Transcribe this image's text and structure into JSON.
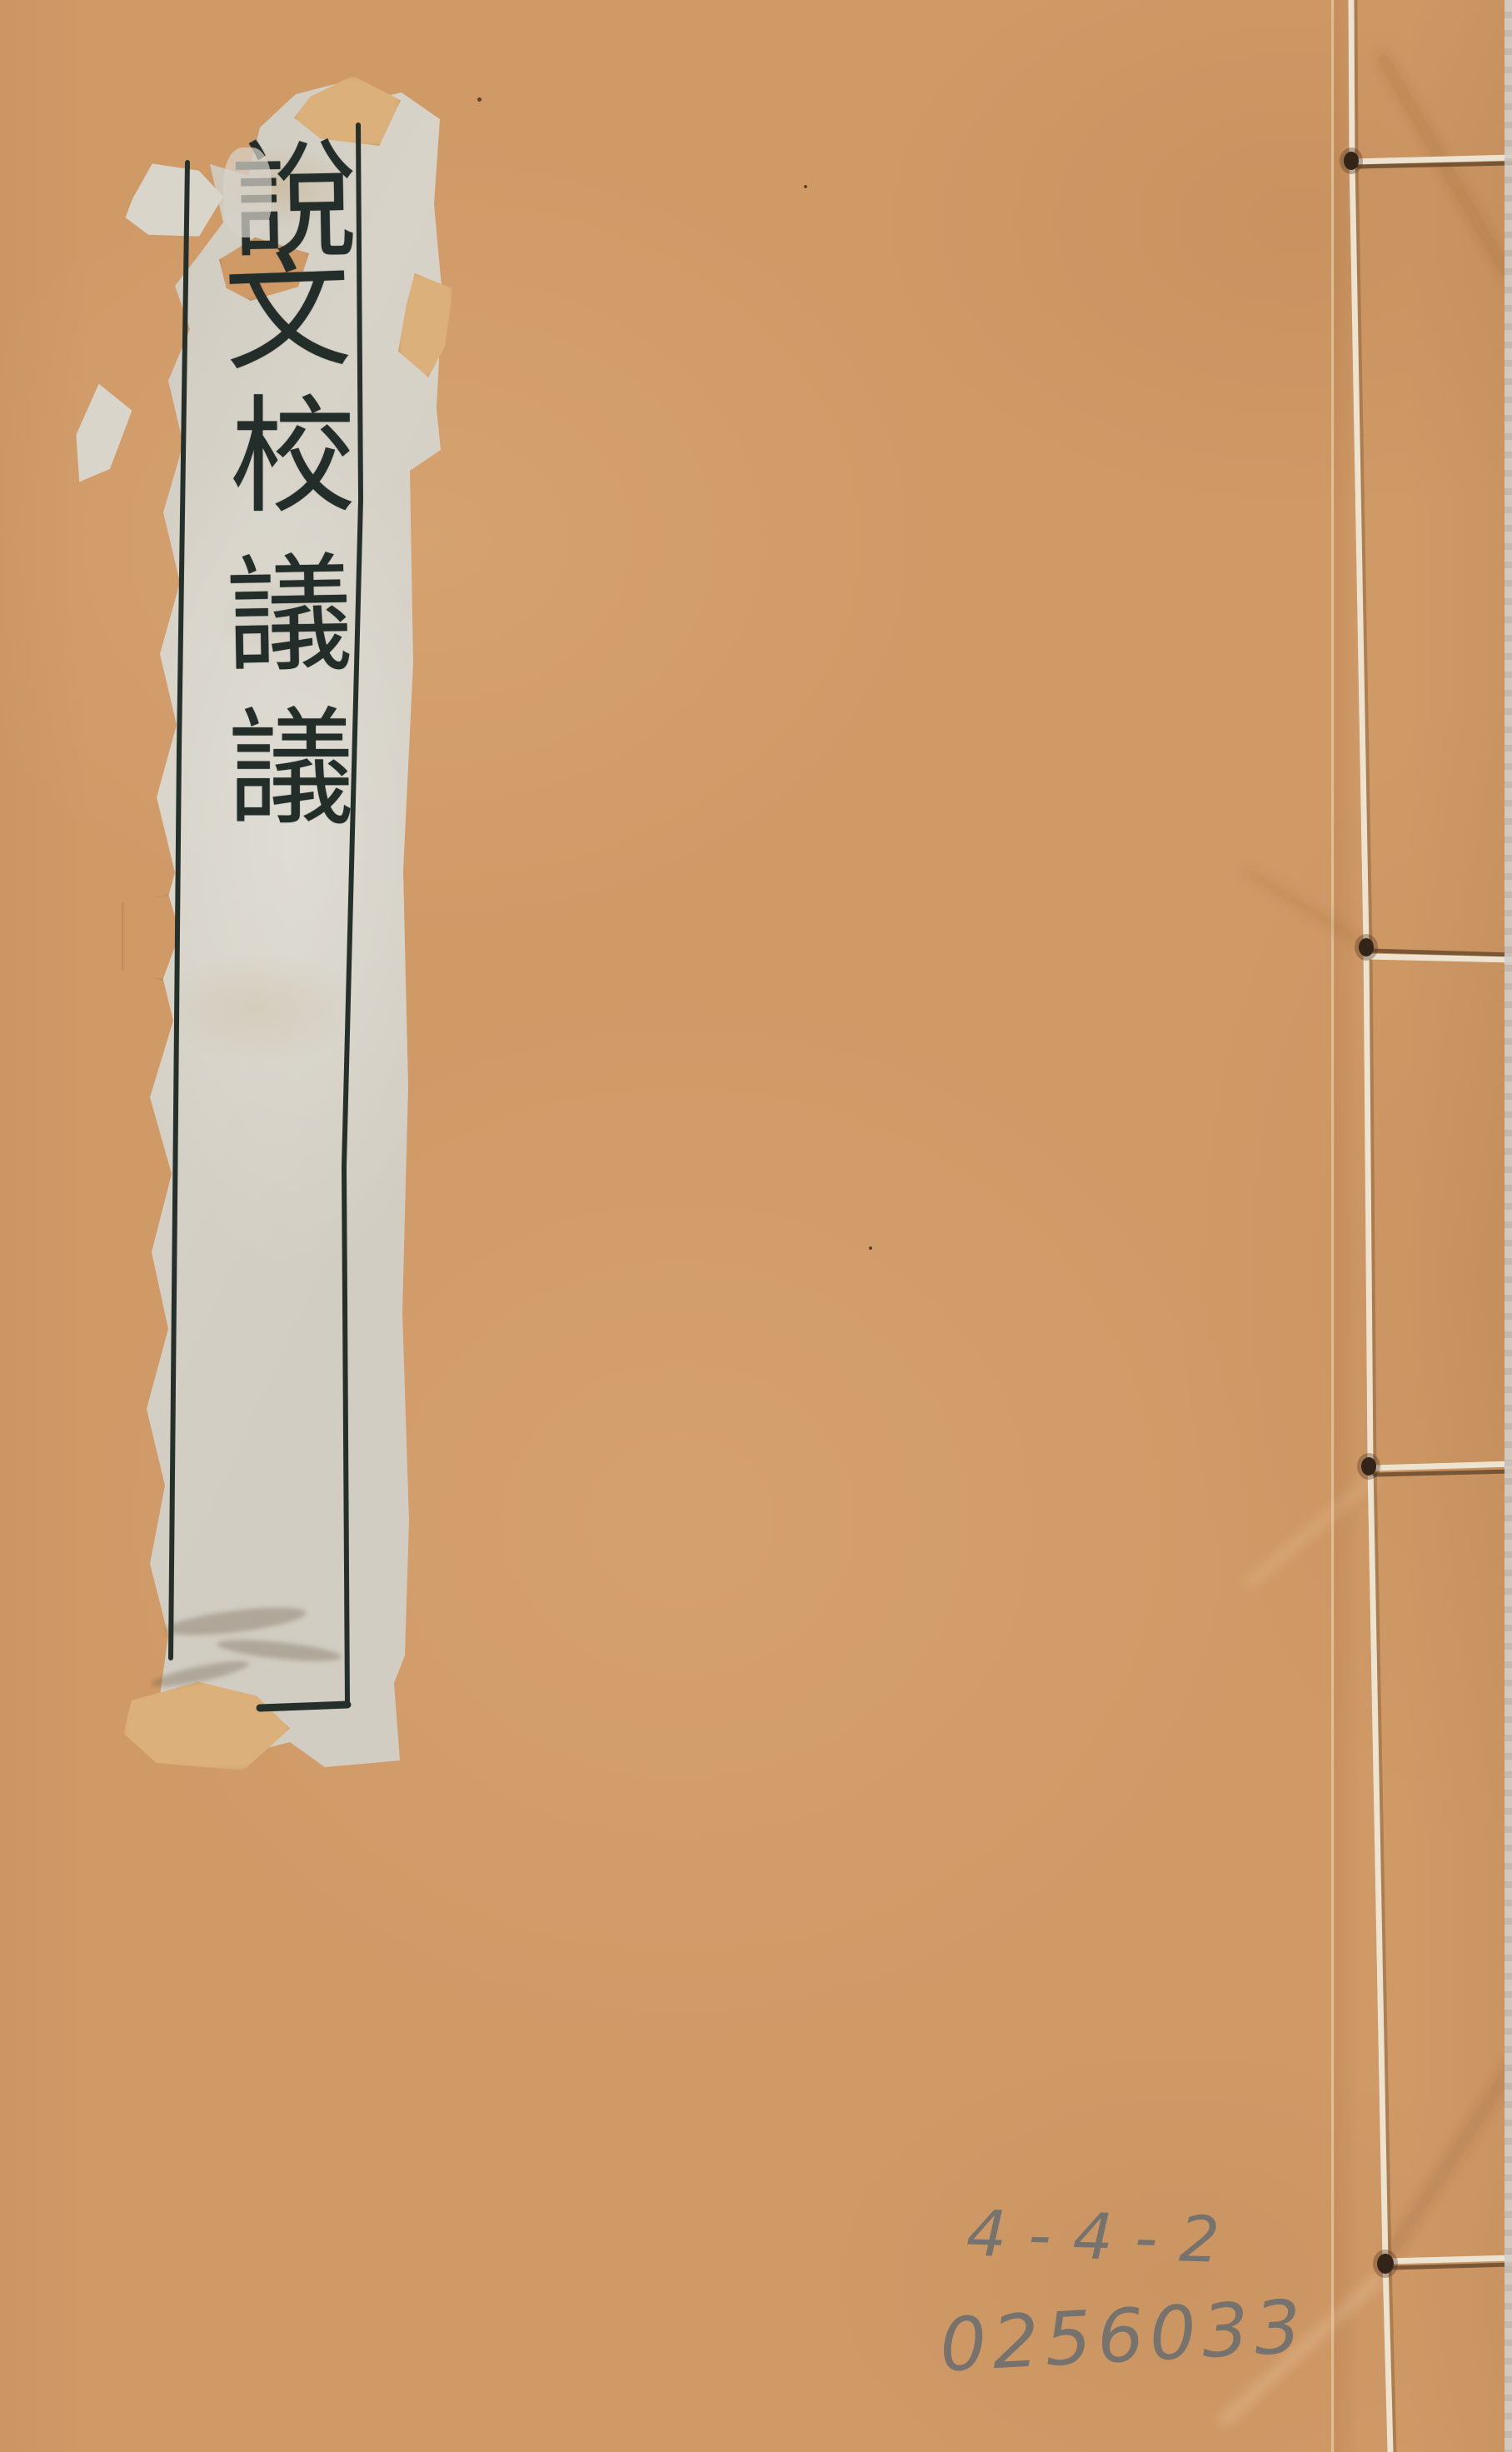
{
  "title_label": {
    "text": "說文校議議",
    "characters": [
      "說",
      "文",
      "校",
      "議",
      "議"
    ]
  },
  "annotations": {
    "line1": "4-4-2",
    "line2": "0256033"
  },
  "binding": {
    "stitch_holes": 4,
    "thread_color": "#ece4d1"
  },
  "colors": {
    "cover": "#d09a67",
    "label_paper": "#d7d3c9",
    "frame_ink": "#25302b",
    "calligraphy_ink": "#232e2a",
    "tape_fragment": "#dcb07a",
    "pencil": "#686c70",
    "stitch_hole": "#33241a",
    "scan_edge": "#cfcac5"
  }
}
